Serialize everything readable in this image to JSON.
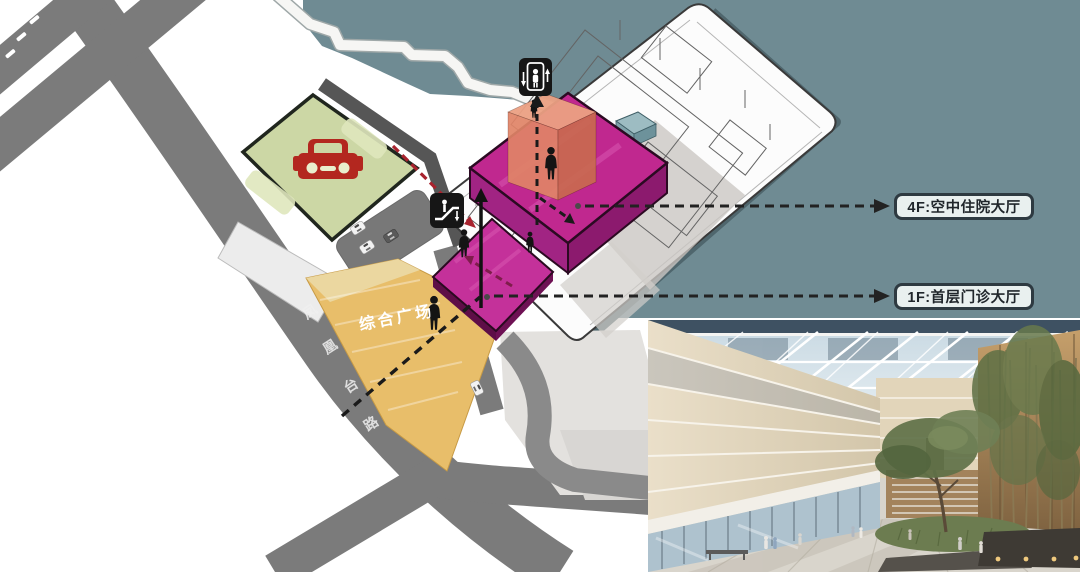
{
  "diagram": {
    "plaza_label": "综合广场",
    "road_name": "凤凰台路",
    "callouts": [
      {
        "id": "4f",
        "label": "4F:空中住院大厅"
      },
      {
        "id": "1f",
        "label": "1F:首层门诊大厅"
      }
    ],
    "icons": [
      "elevator-icon",
      "escalator-icon",
      "car-icon",
      "person-icon",
      "atrium-rendering-photo"
    ],
    "colors": {
      "water": "#6F8B93",
      "water_shadow": "#4F666D",
      "road": "#7B7B7B",
      "parking_green": "#CCD7A5",
      "car_red": "#B3271F",
      "plaza_orange": "#E8BE6A",
      "building_top_magenta": "#C0288F",
      "building_side_magenta": "#8C1A6E",
      "core_salmon": "#E08467",
      "route_red": "#A8232E",
      "route_maroon": "#7E1D4B",
      "route_black": "#1A1A1A",
      "callout_bg": "#E9F0EF",
      "callout_border": "#2E3A41"
    }
  }
}
